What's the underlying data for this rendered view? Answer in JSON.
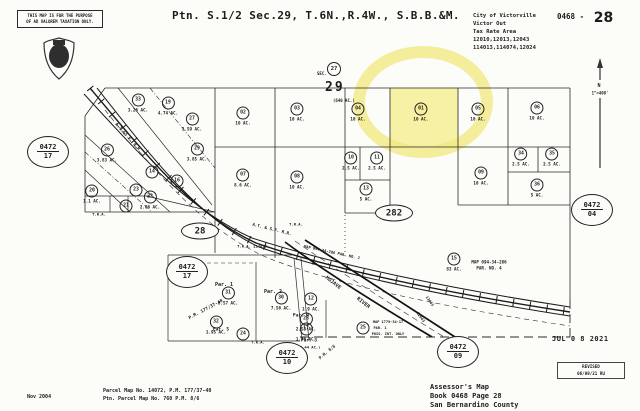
{
  "header": {
    "disclaimer_line1": "THIS MAP IS FOR THE PURPOSE",
    "disclaimer_line2": "OF AD VALOREM TAXATION ONLY.",
    "title": "Ptn. S.1/2 Sec.29, T.6N.,R.4W., S.B.B.&M.",
    "city_block": [
      "City of Victorville",
      "Victor Out",
      "Tax Rate Area",
      "12010,12013,12043",
      "114013,114074,12024"
    ],
    "book_page_prefix": "0468 -",
    "book_page_number": "28"
  },
  "section": {
    "adjacent_circle": "27",
    "sec_label": "SEC.",
    "number": "29",
    "acreage": "(640 AC.)"
  },
  "north": {
    "label": "N",
    "scale": "1\"=400'"
  },
  "highlight": {
    "color": "#f5ef9a"
  },
  "page_refs": [
    {
      "book": "0472",
      "page": "17",
      "x": 48,
      "y": 152
    },
    {
      "book": "0472",
      "page": "17",
      "x": 187,
      "y": 272
    },
    {
      "book": "0472",
      "page": "04",
      "x": 592,
      "y": 210
    },
    {
      "book": "0472",
      "page": "10",
      "x": 287,
      "y": 358
    },
    {
      "book": "0472",
      "page": "09",
      "x": 458,
      "y": 352
    }
  ],
  "road_ovals": [
    {
      "text": "28",
      "x": 200,
      "y": 231
    },
    {
      "text": "282",
      "x": 394,
      "y": 213
    }
  ],
  "parcels": [
    {
      "n": "33",
      "ac": "3.26 AC.",
      "x": 138,
      "y": 103
    },
    {
      "n": "19",
      "ac": "4.74 AC.",
      "x": 168,
      "y": 106
    },
    {
      "n": "27",
      "ac": "3.59 AC.",
      "x": 192,
      "y": 122
    },
    {
      "n": "26",
      "ac": "3.83 AC.",
      "x": 107,
      "y": 153
    },
    {
      "n": "29",
      "ac": "3.85 AC.",
      "x": 197,
      "y": 152
    },
    {
      "n": "14",
      "ac": "",
      "x": 152,
      "y": 172
    },
    {
      "n": "16",
      "ac": "",
      "x": 177,
      "y": 181
    },
    {
      "n": "20",
      "ac": "1.1 AC.",
      "x": 92,
      "y": 194
    },
    {
      "n": "23",
      "ac": "",
      "x": 136,
      "y": 190
    },
    {
      "n": "21",
      "ac": "",
      "x": 126,
      "y": 206
    },
    {
      "n": "22",
      "ac": "2.86 AC.",
      "x": 150,
      "y": 200
    },
    {
      "n": "02",
      "ac": "10 AC.",
      "x": 243,
      "y": 116
    },
    {
      "n": "03",
      "ac": "10 AC.",
      "x": 297,
      "y": 112
    },
    {
      "n": "04",
      "ac": "10 AC.",
      "x": 358,
      "y": 112
    },
    {
      "n": "01",
      "ac": "10 AC.",
      "x": 421,
      "y": 112,
      "hl": true
    },
    {
      "n": "05",
      "ac": "10 AC.",
      "x": 478,
      "y": 112
    },
    {
      "n": "06",
      "ac": "10 AC.",
      "x": 537,
      "y": 111
    },
    {
      "n": "07",
      "ac": "8.6 AC.",
      "x": 243,
      "y": 178
    },
    {
      "n": "08",
      "ac": "10 AC.",
      "x": 297,
      "y": 180
    },
    {
      "n": "10",
      "ac": "2.5 AC.",
      "x": 351,
      "y": 161
    },
    {
      "n": "11",
      "ac": "2.5 AC.",
      "x": 377,
      "y": 161
    },
    {
      "n": "13",
      "ac": "5 AC.",
      "x": 366,
      "y": 192
    },
    {
      "n": "09",
      "ac": "10 AC.",
      "x": 481,
      "y": 176
    },
    {
      "n": "34",
      "ac": "2.5 AC.",
      "x": 521,
      "y": 157
    },
    {
      "n": "35",
      "ac": "2.5 AC.",
      "x": 552,
      "y": 157
    },
    {
      "n": "36",
      "ac": "5 AC.",
      "x": 537,
      "y": 188
    },
    {
      "n": "15",
      "ac": "83 AC.",
      "x": 454,
      "y": 262
    },
    {
      "n": "31",
      "ac": "8.57 AC.",
      "x": 228,
      "y": 296
    },
    {
      "n": "30",
      "ac": "7.56 AC.",
      "x": 281,
      "y": 301
    },
    {
      "n": "12",
      "ac": "1.9 AC.",
      "x": 311,
      "y": 302
    },
    {
      "n": "28",
      "ac": "2.53 AC.",
      "x": 306,
      "y": 322
    },
    {
      "n": "17",
      "ac": "1.76 AC.",
      "x": 306,
      "y": 332
    },
    {
      "n": "32",
      "ac": "1.95 AC.",
      "x": 216,
      "y": 325
    },
    {
      "n": "24",
      "ac": "",
      "x": 243,
      "y": 334
    },
    {
      "n": "25",
      "ac": "",
      "x": 363,
      "y": 328
    }
  ],
  "labels": [
    {
      "t": "APPROX.",
      "x": 194,
      "y": 267,
      "rot": 0,
      "s": 4.5
    },
    {
      "t": "Par. 1",
      "x": 224,
      "y": 285,
      "rot": 0,
      "s": 5
    },
    {
      "t": "Par. 2",
      "x": 273,
      "y": 292,
      "rot": 0,
      "s": 5
    },
    {
      "t": "Par. 3",
      "x": 309,
      "y": 341,
      "rot": 0,
      "s": 4.5
    },
    {
      "t": "(2.44 AC.)",
      "x": 309,
      "y": 347,
      "rot": 0,
      "s": 3.8
    },
    {
      "t": "Par. 4",
      "x": 301,
      "y": 316,
      "rot": 0,
      "s": 4.5
    },
    {
      "t": "Par. 5",
      "x": 221,
      "y": 330,
      "rot": 0,
      "s": 4.5
    },
    {
      "t": "P.M. 177/37-40",
      "x": 206,
      "y": 310,
      "rot": -28,
      "s": 4.5
    },
    {
      "t": "P.M. 8/6",
      "x": 327,
      "y": 352,
      "rot": -40,
      "s": 4.2
    },
    {
      "t": "A.T.&S.F. R.R.",
      "x": 128,
      "y": 138,
      "rot": 48,
      "s": 4.5
    },
    {
      "t": "A.T. & S.F. R.R.",
      "x": 272,
      "y": 229,
      "rot": 14,
      "s": 4.2
    },
    {
      "t": "MOJAVE",
      "x": 333,
      "y": 283,
      "rot": 38,
      "s": 5
    },
    {
      "t": "RIVER",
      "x": 363,
      "y": 303,
      "rot": 38,
      "s": 5
    },
    {
      "t": "T.R.A.",
      "x": 296,
      "y": 224,
      "rot": 0,
      "s": 3.8
    },
    {
      "t": "T.R.A. 114013",
      "x": 252,
      "y": 246,
      "rot": 0,
      "s": 3.8
    },
    {
      "t": "T.R.A.",
      "x": 99,
      "y": 214,
      "rot": 0,
      "s": 3.8
    },
    {
      "t": "T.R.A.",
      "x": 258,
      "y": 342,
      "rot": 0,
      "s": 3.8
    },
    {
      "t": "MAP 094-34-286",
      "x": 489,
      "y": 262,
      "rot": 0,
      "s": 4.2
    },
    {
      "t": "PAR. NO. 4",
      "x": 489,
      "y": 268,
      "rot": 0,
      "s": 4.2
    },
    {
      "t": "MAP 094-34-286 PAR. NO. 2",
      "x": 332,
      "y": 252,
      "rot": 12,
      "s": 3.8
    },
    {
      "t": "MAP 1779-34-17",
      "x": 388,
      "y": 322,
      "rot": 0,
      "s": 3.6
    },
    {
      "t": "PAR. 1",
      "x": 380,
      "y": 328,
      "rot": 0,
      "s": 3.6
    },
    {
      "t": "POSS. INT. ONLY",
      "x": 388,
      "y": 334,
      "rot": 0,
      "s": 3.6
    },
    {
      "t": "13043",
      "x": 430,
      "y": 301,
      "rot": 55,
      "s": 3.8
    },
    {
      "t": "12043",
      "x": 421,
      "y": 317,
      "rot": 55,
      "s": 3.8
    }
  ],
  "stamp": {
    "date_stamp": "JUL 0 8 2021",
    "revised_label": "REVISED",
    "revised_date": "06/09/21 RU"
  },
  "footer": {
    "date": "Nov 2004",
    "map_line1": "Parcel Map No. 14072, P.M. 177/37-40",
    "map_line2": "Ptn. Parcel Map No. 760  P.M. 8/6",
    "assessor_line1": "Assessor's Map",
    "assessor_line2": "Book 0468 Page 28",
    "assessor_line3": "San Bernardino County"
  }
}
